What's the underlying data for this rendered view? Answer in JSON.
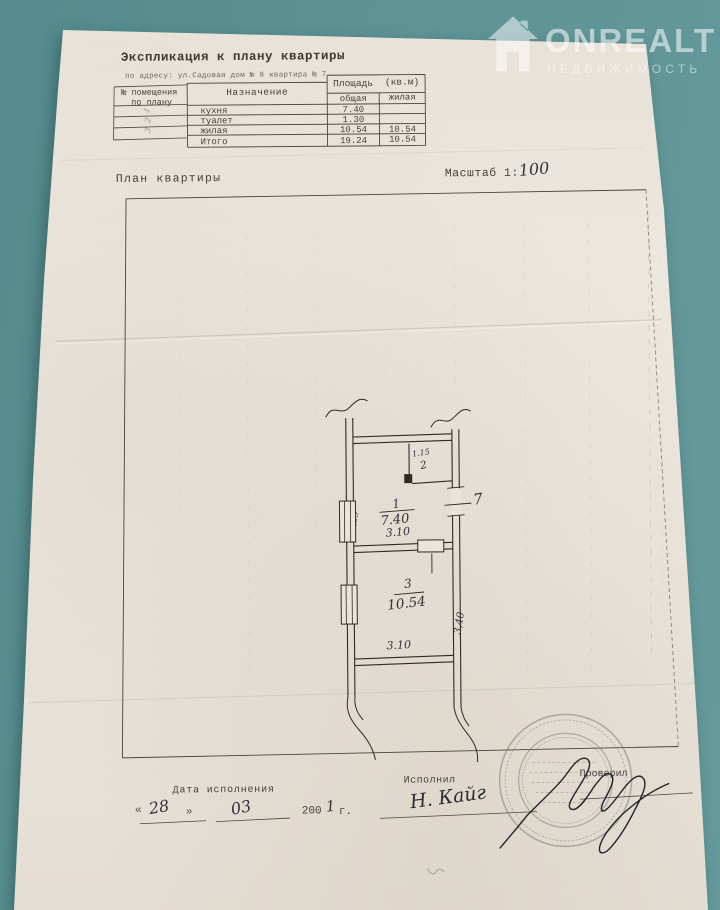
{
  "watermark": {
    "brand": "ONREALT",
    "subtitle": "НЕДВИЖИМОСТЬ"
  },
  "header": {
    "title": "Экспликация к плану квартиры",
    "address": "по адресу: ул.Садовая дом № 8 квартира № 7"
  },
  "table": {
    "col_room_line1": "№ помещения",
    "col_room_line2": "по плану",
    "col_purpose": "Назначение",
    "area_header": "Площадь",
    "area_units": "(кв.м)",
    "col_total": "общая",
    "col_living": "жилая",
    "rows": [
      {
        "num": "1",
        "purpose": "кухня",
        "total": "7.40",
        "living": ""
      },
      {
        "num": "2",
        "purpose": "туалет",
        "total": "1.30",
        "living": ""
      },
      {
        "num": "3",
        "purpose": "жилая",
        "total": "10.54",
        "living": "10.54"
      }
    ],
    "total_label": "Итого",
    "total_total": "19.24",
    "total_living": "10.54"
  },
  "plan_section": {
    "title": "План квартиры",
    "scale_label": "Масштаб 1:",
    "scale_value": "100"
  },
  "plan": {
    "room1_num": "1",
    "room1_area": "7.40",
    "room1_width": "3.10",
    "room2_area": "1.15",
    "room2_num": "2",
    "room3_num": "3",
    "room3_area": "10.54",
    "room3_width": "3.10",
    "dim_left": "2,39",
    "dim_right": "3,40",
    "wall_mark": "7"
  },
  "footer": {
    "date_label": "Дата исполнения",
    "quote_open": "«",
    "day": "28",
    "quote_close": "»",
    "month": "03",
    "year_printed": "200",
    "year_hand": "1",
    "year_suffix": "г.",
    "executor_label": "Исполнил",
    "executor_signature": "Н. Кайг",
    "checker_label": "Проверил"
  },
  "colors": {
    "background": "#5e9395",
    "paper": "#eae4db",
    "ink": "#46423b",
    "stamp": "#6d7f76"
  }
}
